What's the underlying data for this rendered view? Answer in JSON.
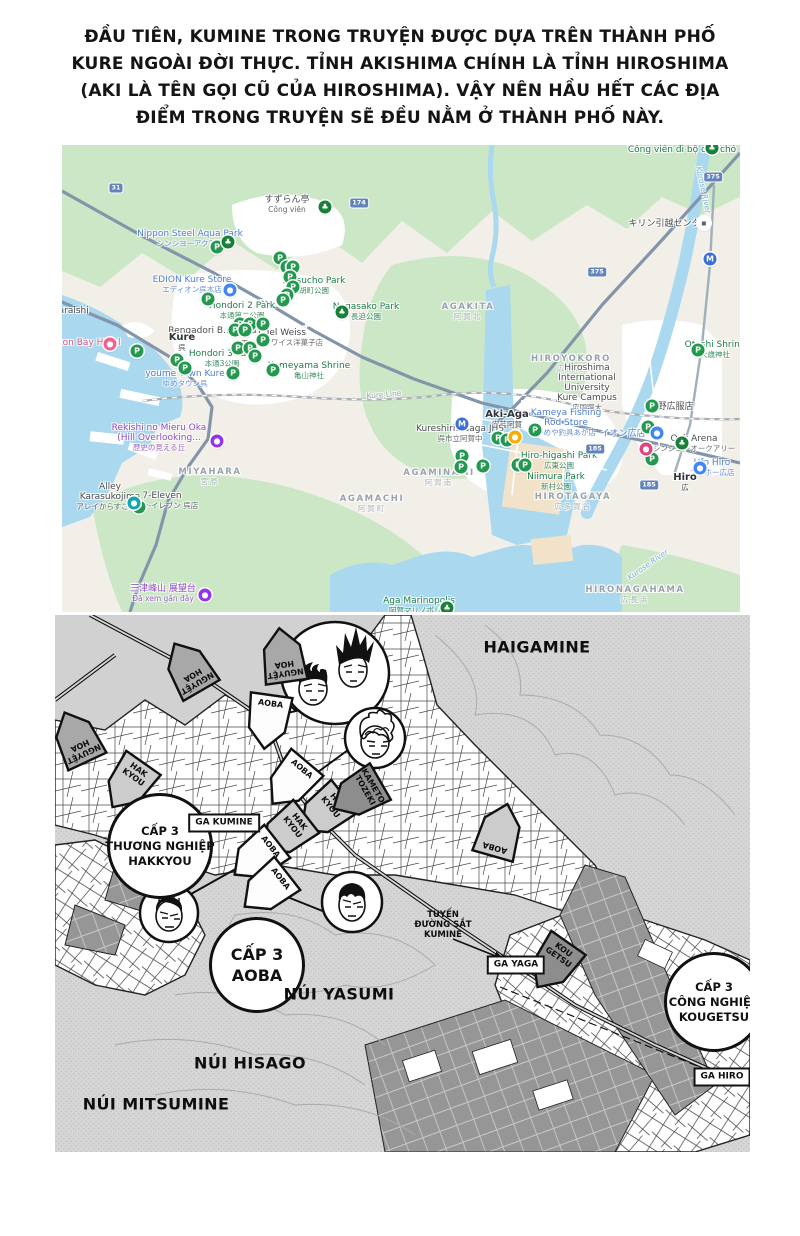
{
  "intro": {
    "lines": [
      "ĐẦU TIÊN, KUMINE TRONG TRUYỆN ĐƯỢC DỰA TRÊN THÀNH PHỐ",
      "KURE NGOÀI ĐỜI THỰC. TỈNH AKISHIMA CHÍNH LÀ TỈNH HIROSHIMA",
      "(AKI LÀ TÊN GỌI CŨ CỦA HIROSHIMA). VẬY NÊN HẦU HẾT CÁC ĐỊA",
      "ĐIỂM TRONG TRUYỆN SẼ ĐỀU NẰM Ở THÀNH PHỐ NÀY."
    ]
  },
  "gmap": {
    "colors": {
      "land": "#f2efe8",
      "green": "#cbe7c6",
      "water": "#a9d8ef",
      "urban": "#ffffff",
      "road": "#8295a9"
    },
    "glyphs": {
      "parking": "P",
      "park": "♣",
      "store_blue": "●",
      "hotel_pink": "●",
      "store_magenta": "●",
      "recent_purple": "●",
      "cafe_yellow": "●",
      "mover_white": "▪",
      "transit_blue": "M",
      "attraction_teal": "●"
    },
    "labels": [
      {
        "x": 225,
        "y": 60,
        "t": "すずらん亭",
        "c": "dark",
        "sub": "Công viên"
      },
      {
        "x": 128,
        "y": 94,
        "t": "Nippon Steel Aqua Park",
        "c": "blue",
        "sub": "シンシヨーアクアパ"
      },
      {
        "x": 130,
        "y": 140,
        "t": "EDION Kure Store",
        "c": "blue",
        "sub": "エディオン呉本店"
      },
      {
        "x": 252,
        "y": 141,
        "t": "Ebisucho Park",
        "c": "green",
        "sub": "胡町公園"
      },
      {
        "x": 304,
        "y": 167,
        "t": "Nagasako Park",
        "c": "green",
        "sub": "長迫公園"
      },
      {
        "x": 180,
        "y": 166,
        "t": "Hondori 2 Park",
        "c": "green",
        "sub": "本通第二公園"
      },
      {
        "x": 155,
        "y": 186,
        "t": "Rengadori B..re (Na..)",
        "c": "dark"
      },
      {
        "x": 220,
        "y": 193,
        "t": "Edel Weiss",
        "c": "dark",
        "sub": "エーデルワイス洋菓子店"
      },
      {
        "x": 120,
        "y": 198,
        "t": "Kure",
        "c": "town",
        "sub": "呉"
      },
      {
        "x": 160,
        "y": 214,
        "t": "Hondori 3 Park",
        "c": "green",
        "sub": "本通3公園"
      },
      {
        "x": 247,
        "y": 226,
        "t": "Kameyama Shrine",
        "c": "green",
        "sub": "亀山神社"
      },
      {
        "x": 18,
        "y": 198,
        "t": "Clayton Bay Hotel",
        "c": "pink"
      },
      {
        "x": 123,
        "y": 234,
        "t": "youme Town Kure",
        "c": "blue",
        "sub": "ゆめタウン呉"
      },
      {
        "x": 97,
        "y": 293,
        "t": "Rekishi no Mieru Oka|(Hill Overlooking...",
        "c": "purple",
        "sub": "歴史の見える丘"
      },
      {
        "x": 148,
        "y": 332,
        "t": "MIYAHARA",
        "c": "area",
        "sub": "宮原"
      },
      {
        "x": 48,
        "y": 352,
        "t": "Alley|Karasukojima",
        "c": "dark",
        "sub": "アレイからすこじま"
      },
      {
        "x": 100,
        "y": 356,
        "t": "7-Eleven",
        "c": "dark",
        "sub": "セブン-イレブン 呉店"
      },
      {
        "x": 101,
        "y": 449,
        "t": "三津峰山 展望台",
        "c": "purple",
        "sub": "Đã xem gần đây"
      },
      {
        "x": 310,
        "y": 359,
        "t": "AGAMACHI",
        "c": "area",
        "sub": "阿賀町"
      },
      {
        "x": 406,
        "y": 167,
        "t": "AGAKITA",
        "c": "area",
        "sub": "阿賀北"
      },
      {
        "x": 509,
        "y": 219,
        "t": "HIROYOKORO",
        "c": "area",
        "sub": "広横路"
      },
      {
        "x": 525,
        "y": 243,
        "t": "Hiroshima|International|University|Kure Campus",
        "c": "dark",
        "sub": "広国際大"
      },
      {
        "x": 620,
        "y": 5,
        "t": "Công viên đi bộ cho chó",
        "c": "green"
      },
      {
        "x": 607,
        "y": 79,
        "t": "キリン引越センター",
        "c": "dark"
      },
      {
        "x": 653,
        "y": 205,
        "t": "Otoshi Shrine",
        "c": "green",
        "sub": "大歳神社"
      },
      {
        "x": 445,
        "y": 275,
        "t": "Aki-Aga",
        "c": "town",
        "sub": "安芸阿賀"
      },
      {
        "x": 398,
        "y": 289,
        "t": "Kureshiritsuaga JHS",
        "c": "dark",
        "sub": "呉市立阿賀中"
      },
      {
        "x": 504,
        "y": 278,
        "t": "Kameya Fishing|Rod Store",
        "c": "blue",
        "sub": "かめや釣具あが店"
      },
      {
        "x": 497,
        "y": 316,
        "t": "Hiro-higashi Park",
        "c": "green",
        "sub": "広東公園"
      },
      {
        "x": 494,
        "y": 337,
        "t": "Niimura Park",
        "c": "green",
        "sub": "新村公園"
      },
      {
        "x": 377,
        "y": 333,
        "t": "AGAMINAMI",
        "c": "area",
        "sub": "阿賀南"
      },
      {
        "x": 511,
        "y": 357,
        "t": "HIROTAGAYA",
        "c": "area",
        "sub": "広多賀谷"
      },
      {
        "x": 573,
        "y": 450,
        "t": "HIRONAGAHAMA",
        "c": "area",
        "sub": "広長浜"
      },
      {
        "x": 561,
        "y": 289,
        "t": "イオン広店",
        "c": "blue"
      },
      {
        "x": 609,
        "y": 262,
        "t": "日野広服店",
        "c": "dark"
      },
      {
        "x": 632,
        "y": 299,
        "t": "Oak Arena",
        "c": "dark",
        "sub": "シンシヨーオークアリー"
      },
      {
        "x": 650,
        "y": 323,
        "t": "Ufo Hiro",
        "c": "blue",
        "sub": "ユーホー広店"
      },
      {
        "x": 623,
        "y": 338,
        "t": "Hiro",
        "c": "town",
        "sub": "広"
      },
      {
        "x": 357,
        "y": 461,
        "t": "Aga Marinopolis",
        "c": "green",
        "sub": "阿賀マリノポリス"
      },
      {
        "x": 322,
        "y": 250,
        "t": "Kure Line",
        "c": "gray",
        "rot": -5
      },
      {
        "x": 641,
        "y": 45,
        "t": "Kurose River",
        "c": "water",
        "rot": 78
      },
      {
        "x": 586,
        "y": 420,
        "t": "Kurose River",
        "c": "water",
        "rot": -35
      },
      {
        "x": 8,
        "y": 166,
        "t": "waraishi",
        "c": "dark"
      }
    ],
    "markers": [
      {
        "x": 155,
        "y": 102,
        "t": "parking"
      },
      {
        "x": 218,
        "y": 113,
        "t": "parking"
      },
      {
        "x": 225,
        "y": 122,
        "t": "parking"
      },
      {
        "x": 231,
        "y": 122,
        "t": "parking"
      },
      {
        "x": 228,
        "y": 132,
        "t": "parking"
      },
      {
        "x": 231,
        "y": 142,
        "t": "parking"
      },
      {
        "x": 225,
        "y": 150,
        "t": "parking"
      },
      {
        "x": 221,
        "y": 155,
        "t": "parking"
      },
      {
        "x": 146,
        "y": 154,
        "t": "parking"
      },
      {
        "x": 178,
        "y": 179,
        "t": "parking"
      },
      {
        "x": 188,
        "y": 179,
        "t": "parking"
      },
      {
        "x": 201,
        "y": 179,
        "t": "parking"
      },
      {
        "x": 173,
        "y": 185,
        "t": "parking"
      },
      {
        "x": 183,
        "y": 185,
        "t": "parking"
      },
      {
        "x": 176,
        "y": 203,
        "t": "parking"
      },
      {
        "x": 188,
        "y": 203,
        "t": "parking"
      },
      {
        "x": 193,
        "y": 211,
        "t": "parking"
      },
      {
        "x": 201,
        "y": 195,
        "t": "parking"
      },
      {
        "x": 75,
        "y": 206,
        "t": "parking"
      },
      {
        "x": 115,
        "y": 215,
        "t": "parking"
      },
      {
        "x": 123,
        "y": 223,
        "t": "parking"
      },
      {
        "x": 171,
        "y": 228,
        "t": "parking"
      },
      {
        "x": 211,
        "y": 225,
        "t": "parking"
      },
      {
        "x": 77,
        "y": 362,
        "t": "parking"
      },
      {
        "x": 636,
        "y": 205,
        "t": "parking"
      },
      {
        "x": 590,
        "y": 261,
        "t": "parking"
      },
      {
        "x": 586,
        "y": 282,
        "t": "parking"
      },
      {
        "x": 590,
        "y": 314,
        "t": "parking"
      },
      {
        "x": 400,
        "y": 311,
        "t": "parking"
      },
      {
        "x": 399,
        "y": 322,
        "t": "parking"
      },
      {
        "x": 456,
        "y": 320,
        "t": "parking"
      },
      {
        "x": 463,
        "y": 320,
        "t": "parking"
      },
      {
        "x": 421,
        "y": 321,
        "t": "parking"
      },
      {
        "x": 436,
        "y": 293,
        "t": "parking"
      },
      {
        "x": 445,
        "y": 295,
        "t": "parking"
      },
      {
        "x": 473,
        "y": 285,
        "t": "parking"
      },
      {
        "x": 166,
        "y": 97,
        "t": "park"
      },
      {
        "x": 263,
        "y": 62,
        "t": "park"
      },
      {
        "x": 280,
        "y": 167,
        "t": "park"
      },
      {
        "x": 650,
        "y": 3,
        "t": "park"
      },
      {
        "x": 620,
        "y": 298,
        "t": "park"
      },
      {
        "x": 385,
        "y": 463,
        "t": "park"
      },
      {
        "x": 168,
        "y": 145,
        "t": "store_blue"
      },
      {
        "x": 595,
        "y": 288,
        "t": "store_blue"
      },
      {
        "x": 638,
        "y": 323,
        "t": "store_blue"
      },
      {
        "x": 48,
        "y": 199,
        "t": "hotel_pink"
      },
      {
        "x": 584,
        "y": 304,
        "t": "store_magenta"
      },
      {
        "x": 155,
        "y": 296,
        "t": "recent_purple"
      },
      {
        "x": 143,
        "y": 450,
        "t": "recent_purple"
      },
      {
        "x": 453,
        "y": 292,
        "t": "cafe_yellow"
      },
      {
        "x": 642,
        "y": 78,
        "t": "mover_white"
      },
      {
        "x": 648,
        "y": 114,
        "t": "transit_blue"
      },
      {
        "x": 400,
        "y": 279,
        "t": "transit_blue"
      },
      {
        "x": 72,
        "y": 358,
        "t": "attraction_teal"
      }
    ],
    "shields": [
      {
        "x": 54,
        "y": 43,
        "n": "31"
      },
      {
        "x": 297,
        "y": 58,
        "n": "174"
      },
      {
        "x": 651,
        "y": 32,
        "n": "375"
      },
      {
        "x": 535,
        "y": 127,
        "n": "375"
      },
      {
        "x": 533,
        "y": 304,
        "n": "185"
      },
      {
        "x": 587,
        "y": 340,
        "n": "185"
      }
    ]
  },
  "manga": {
    "regions": [
      {
        "x": 482,
        "y": 32,
        "t": "HAIGAMINE"
      },
      {
        "x": 284,
        "y": 379,
        "t": "NÚI YASUMI"
      },
      {
        "x": 195,
        "y": 448,
        "t": "NÚI HISAGO"
      },
      {
        "x": 101,
        "y": 489,
        "t": "NÚI MITSUMINE"
      }
    ],
    "schools": [
      {
        "x": 105,
        "y": 231,
        "r": 50,
        "lines": [
          "CẤP 3",
          "THƯƠNG NGHIỆP",
          "HAKKYOU"
        ]
      },
      {
        "x": 202,
        "y": 350,
        "r": 45,
        "lines": [
          "CẤP 3",
          "AOBA"
        ]
      },
      {
        "x": 659,
        "y": 387,
        "r": 47,
        "lines": [
          "CẤP 3",
          "CÔNG NGHIỆP",
          "KOUGETSU"
        ]
      }
    ],
    "stations": [
      {
        "x": 169,
        "y": 208,
        "t": "GA KUMINE"
      },
      {
        "x": 461,
        "y": 350,
        "t": "GA YAGA"
      },
      {
        "x": 667,
        "y": 462,
        "t": "GA HIRO"
      }
    ],
    "pennants": [
      {
        "x": 133,
        "y": 52,
        "t": "NGUYỆT HOA",
        "rot": 150,
        "f": "mid",
        "two": true
      },
      {
        "x": 228,
        "y": 40,
        "t": "NGUYỆT HOA",
        "rot": 172,
        "f": "mid",
        "two": true
      },
      {
        "x": 21,
        "y": 122,
        "t": "NGUYỆT HOA",
        "rot": 155,
        "f": "mid",
        "two": true
      },
      {
        "x": 213,
        "y": 107,
        "t": "AOBA",
        "rot": 8,
        "f": "white"
      },
      {
        "x": 235,
        "y": 168,
        "t": "AOBA",
        "rot": 40,
        "f": "white"
      },
      {
        "x": 73,
        "y": 170,
        "t": "HAK KYOU",
        "rot": 35,
        "f": "light",
        "two": true
      },
      {
        "x": 268,
        "y": 198,
        "t": "HAK KYOU",
        "rot": 52,
        "f": "light",
        "two": true
      },
      {
        "x": 230,
        "y": 218,
        "t": "HAK KYOU",
        "rot": 52,
        "f": "light",
        "two": true
      },
      {
        "x": 302,
        "y": 180,
        "t": "KAMETO TOZEKI",
        "rot": 60,
        "f": "dark",
        "two": true
      },
      {
        "x": 201,
        "y": 243,
        "t": "AOBA",
        "rot": 52,
        "f": "white"
      },
      {
        "x": 211,
        "y": 275,
        "t": "AOBA",
        "rot": 52,
        "f": "white"
      },
      {
        "x": 445,
        "y": 215,
        "t": "AOBA",
        "rot": 196,
        "f": "light"
      },
      {
        "x": 498,
        "y": 350,
        "t": "KOU GETSU",
        "rot": 35,
        "f": "dark",
        "two": true
      }
    ],
    "pennant_fills": {
      "mid": "#a8a8a8",
      "light": "#cccccc",
      "white": "#fdfdfd",
      "dark": "#8d8d8d"
    },
    "note": {
      "x": 388,
      "y": 310,
      "lines": [
        "TUYẾN",
        "ĐƯỜNG SẮT",
        "KUMINE"
      ]
    }
  }
}
